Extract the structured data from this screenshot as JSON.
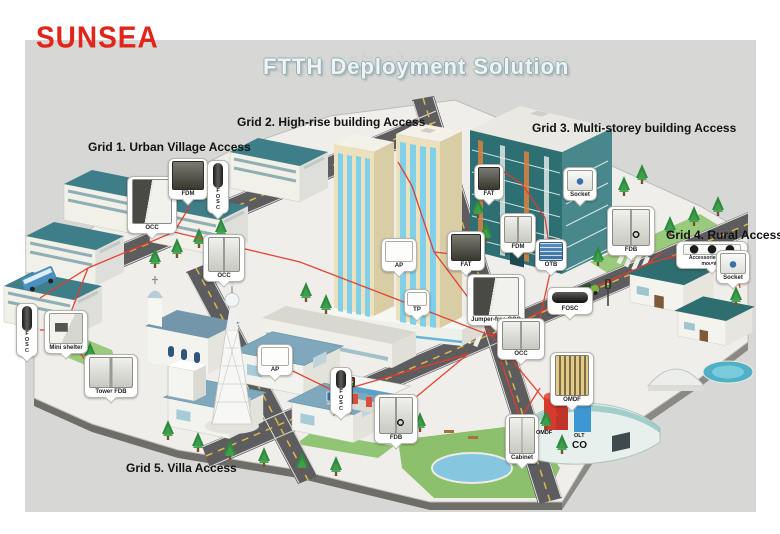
{
  "brand": {
    "logo": "SUNSEA"
  },
  "title": "FTTH Deployment Solution",
  "grids": [
    {
      "label": "Grid 1. Urban Village Access"
    },
    {
      "label": "Grid 2. High-rise building Access"
    },
    {
      "label": "Grid 3. Multi-storey building Access"
    },
    {
      "label": "Grid 4. Rural Access"
    },
    {
      "label": "Grid 5. Villa Access"
    }
  ],
  "callouts": [
    {
      "label": "OCC"
    },
    {
      "label": "FDM"
    },
    {
      "label": "FOSC"
    },
    {
      "label": "OCC"
    },
    {
      "label": "FOSC"
    },
    {
      "label": "Mini shelter"
    },
    {
      "label": "Tower FDB"
    },
    {
      "label": "AP"
    },
    {
      "label": "TP"
    },
    {
      "label": "FAT"
    },
    {
      "label": "Jumper-free OCC"
    },
    {
      "label": "OCC"
    },
    {
      "label": "FAT"
    },
    {
      "label": "Socket"
    },
    {
      "label": "FDM"
    },
    {
      "label": "OTB"
    },
    {
      "label": "FOSC"
    },
    {
      "label": "FDB"
    },
    {
      "label": "Accessories Aerial-mounted"
    },
    {
      "label": "Socket"
    },
    {
      "label": "AP"
    },
    {
      "label": "FOSC"
    },
    {
      "label": "FDB"
    },
    {
      "label": "Cabinet"
    },
    {
      "label": "OMDF"
    }
  ],
  "co_area": {
    "omdf": "OMDF",
    "olt": "OLT",
    "co": "CO"
  },
  "colors": {
    "logo_red": "#e1251b",
    "fiber_red": "#e33b2c",
    "title_silver": "#eef3f4",
    "panel_gray": "#d7d7d5"
  }
}
